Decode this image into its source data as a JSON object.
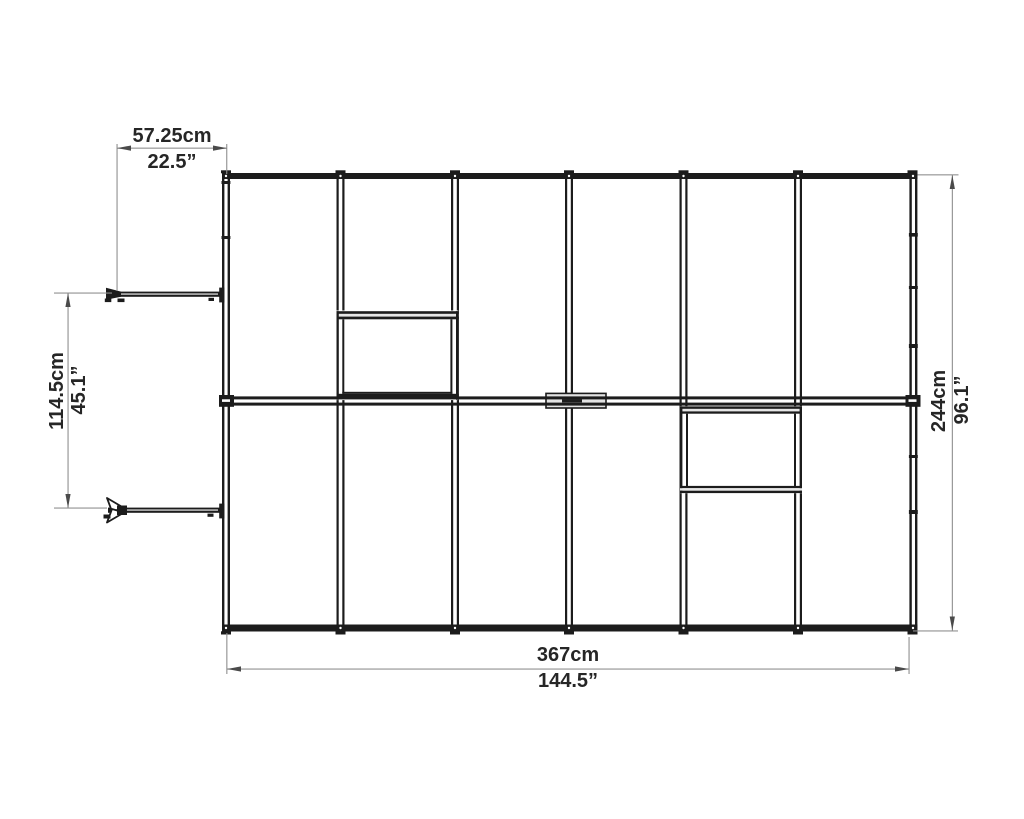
{
  "diagram": {
    "type": "greenhouse-floor-plan-top-view",
    "background": "#ffffff",
    "line_color": "#1c1c1c",
    "dim_line_color": "#8f8f8f",
    "arrow_color": "#4a4a4a",
    "text_color": "#262626",
    "panel_columns": 6,
    "roof_vents": 2,
    "door_leaves": 2,
    "dimensions": {
      "door_leaf_width": {
        "cm": "57.25cm",
        "inch": "22.5”"
      },
      "door_opening_width": {
        "cm": "114.5cm",
        "inch": "45.1”"
      },
      "overall_depth": {
        "cm": "244cm",
        "inch": "96.1”"
      },
      "overall_width": {
        "cm": "367cm",
        "inch": "144.5”"
      }
    }
  }
}
